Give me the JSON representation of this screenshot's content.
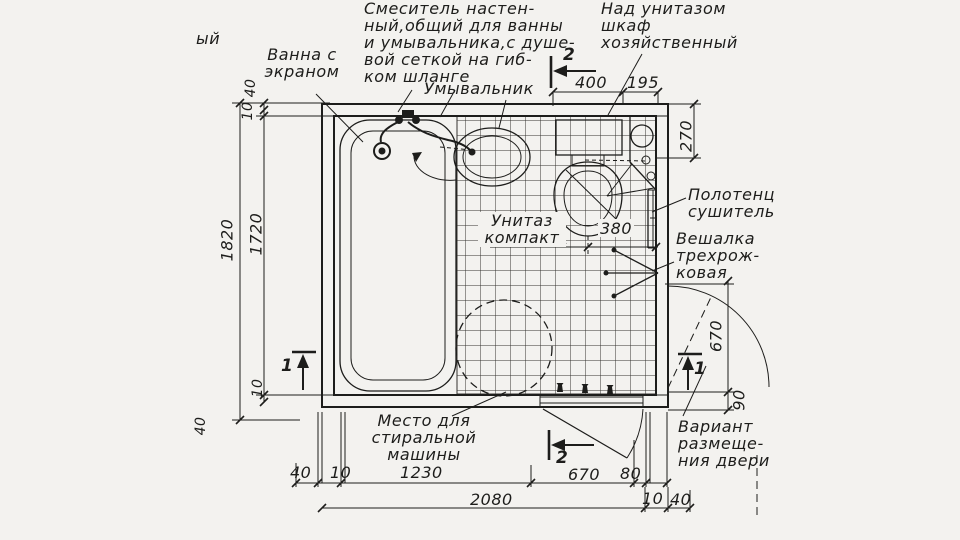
{
  "labels": {
    "partial_left": "ый",
    "bath": "Ванна с\nэкраном",
    "mixer": "Смеситель настен-\nный,общий для ванны\nи умывальника,с душе-\nвой сеткой на гиб-\nком шланге",
    "sink": "Умывальник",
    "cabinet": "Над унитазом\nшкаф\nхозяйственный",
    "towel_dryer": "Полотенце-\nсушитель",
    "hanger": "Вешалка\nтрехрож-\nковая",
    "toilet": "Унитаз\nкомпакт",
    "washing_machine": "Место для\nстиральной\nмашины",
    "door_variant": "Вариант\nразмеще-\nния двери"
  },
  "dims": {
    "overall_h": "1820",
    "inner_h": "1720",
    "left_top": [
      "40",
      "10"
    ],
    "left_bottom": [
      "10",
      "40"
    ],
    "top_w": [
      "400",
      "195"
    ],
    "right": [
      "270",
      "670",
      "90"
    ],
    "toilet_offset": "380",
    "bottom_row1": [
      "40",
      "10",
      "1230",
      "670",
      "80"
    ],
    "bottom_row2": [
      "2080",
      "10",
      "40"
    ]
  },
  "marks": {
    "one": "1",
    "two": "2"
  },
  "colors": {
    "ink": "#1d1d1b",
    "paper": "#f3f2ef"
  }
}
